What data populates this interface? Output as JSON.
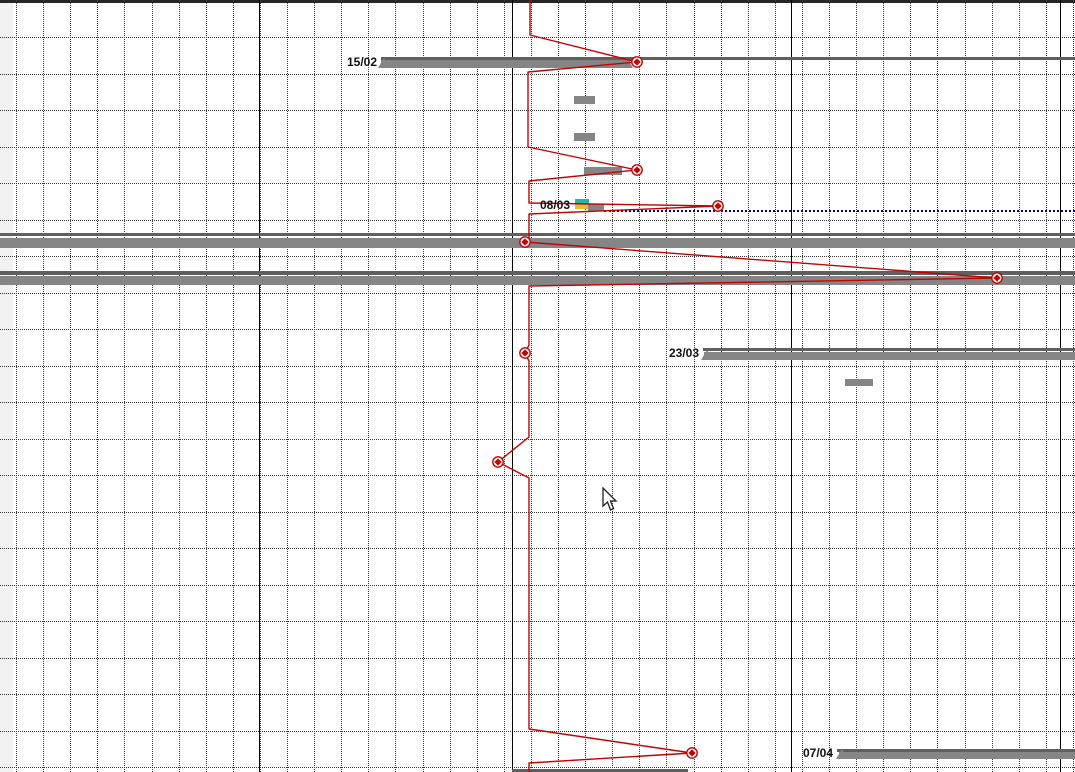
{
  "app": {
    "view": "gantt-chart-pane"
  },
  "chart_data": {
    "type": "gantt",
    "title": "",
    "grid": {
      "v_start": 16,
      "v_step": 27.1,
      "v_count": 40,
      "h_start": 37,
      "h_step": 36.5,
      "h_count": 21,
      "solid_columns": [
        259,
        512,
        791,
        1060
      ],
      "grid_on": true
    },
    "colors": {
      "bar_gray": "#858585",
      "bar_dark": "#5f5f5f",
      "progress_red": "#c00404",
      "split_navy": "#00008b",
      "stripe_teal": "#2ab5a5",
      "stripe_yellow": "#e0c233",
      "top_edge": "#262626",
      "left_strip": "#f2f2f2",
      "label_black": "#111111"
    },
    "task_bars": [
      {
        "name": "summary-thinline-15-02",
        "x": 381,
        "y": 57,
        "w": 694,
        "h": 3,
        "color": "bar_dark"
      },
      {
        "name": "summary-bar-15-02",
        "x": 381,
        "y": 60,
        "w": 249,
        "h": 8,
        "color": "bar_gray",
        "tri": "both"
      },
      {
        "name": "task-bar-small-1",
        "x": 574,
        "y": 96,
        "w": 21,
        "h": 8,
        "color": "bar_gray"
      },
      {
        "name": "task-bar-small-2",
        "x": 574,
        "y": 133,
        "w": 21,
        "h": 8,
        "color": "bar_gray"
      },
      {
        "name": "task-bar-small-3",
        "x": 584,
        "y": 167,
        "w": 38,
        "h": 8,
        "color": "bar_gray"
      },
      {
        "name": "stripe-teal-08-03",
        "x": 575,
        "y": 199,
        "w": 14,
        "h": 5,
        "color": "stripe_teal"
      },
      {
        "name": "stripe-yellow-08-03",
        "x": 575,
        "y": 204,
        "w": 14,
        "h": 5,
        "color": "stripe_yellow"
      },
      {
        "name": "task-bar-08-03",
        "x": 588,
        "y": 204,
        "w": 16,
        "h": 7,
        "color": "bar_gray"
      },
      {
        "name": "summary-thinline-row-a",
        "x": 0,
        "y": 233,
        "w": 1075,
        "h": 3,
        "color": "bar_dark"
      },
      {
        "name": "summary-bar-row-a",
        "x": 0,
        "y": 238,
        "w": 1075,
        "h": 10,
        "color": "bar_gray"
      },
      {
        "name": "summary-thinline-row-b",
        "x": 0,
        "y": 271,
        "w": 1075,
        "h": 3.5,
        "color": "bar_dark"
      },
      {
        "name": "summary-bar-row-b",
        "x": 0,
        "y": 276,
        "w": 1075,
        "h": 9,
        "color": "bar_gray"
      },
      {
        "name": "summary-thinline-23-03",
        "x": 703,
        "y": 348,
        "w": 372,
        "h": 3,
        "color": "bar_dark"
      },
      {
        "name": "summary-bar-23-03",
        "x": 704,
        "y": 352,
        "w": 371,
        "h": 8,
        "color": "bar_gray",
        "tri": "left"
      },
      {
        "name": "task-bar-small-4",
        "x": 845,
        "y": 379,
        "w": 28,
        "h": 7,
        "color": "bar_gray"
      },
      {
        "name": "summary-thinline-07-04",
        "x": 837,
        "y": 749,
        "w": 238,
        "h": 2.5,
        "color": "bar_dark"
      },
      {
        "name": "summary-bar-07-04",
        "x": 839,
        "y": 752,
        "w": 236,
        "h": 7,
        "color": "bar_gray",
        "tri": "left"
      },
      {
        "name": "clipped-bar-bottom",
        "x": 512,
        "y": 768.5,
        "w": 176,
        "h": 3.5,
        "color": "bar_dark"
      }
    ],
    "split_line": {
      "x1": 604,
      "x2": 1075,
      "y": 210
    },
    "progress_line": {
      "points": [
        [
          530,
          0
        ],
        [
          530,
          35
        ],
        [
          637,
          62
        ],
        [
          528,
          72
        ],
        [
          528,
          147
        ],
        [
          637,
          170
        ],
        [
          529,
          181
        ],
        [
          529,
          203
        ],
        [
          718,
          206
        ],
        [
          529,
          214
        ],
        [
          529,
          240
        ],
        [
          525,
          242
        ],
        [
          997,
          278
        ],
        [
          529,
          286
        ],
        [
          529,
          345
        ],
        [
          525,
          353
        ],
        [
          529,
          361
        ],
        [
          529,
          437
        ],
        [
          498,
          462
        ],
        [
          529,
          478
        ],
        [
          529,
          729
        ],
        [
          692,
          753
        ],
        [
          529,
          763
        ],
        [
          529,
          772
        ]
      ],
      "markers": [
        [
          637,
          62
        ],
        [
          637,
          170
        ],
        [
          718,
          206
        ],
        [
          525,
          242
        ],
        [
          997,
          278
        ],
        [
          525,
          353
        ],
        [
          498,
          462
        ],
        [
          692,
          753
        ]
      ]
    },
    "milestone_labels": [
      {
        "text": "15/02",
        "x": 377,
        "y": 62
      },
      {
        "text": "08/03",
        "x": 570,
        "y": 205
      },
      {
        "text": "23/03",
        "x": 699,
        "y": 353
      },
      {
        "text": "07/04",
        "x": 833,
        "y": 753
      }
    ],
    "cursor": {
      "x": 602,
      "y": 487
    }
  }
}
